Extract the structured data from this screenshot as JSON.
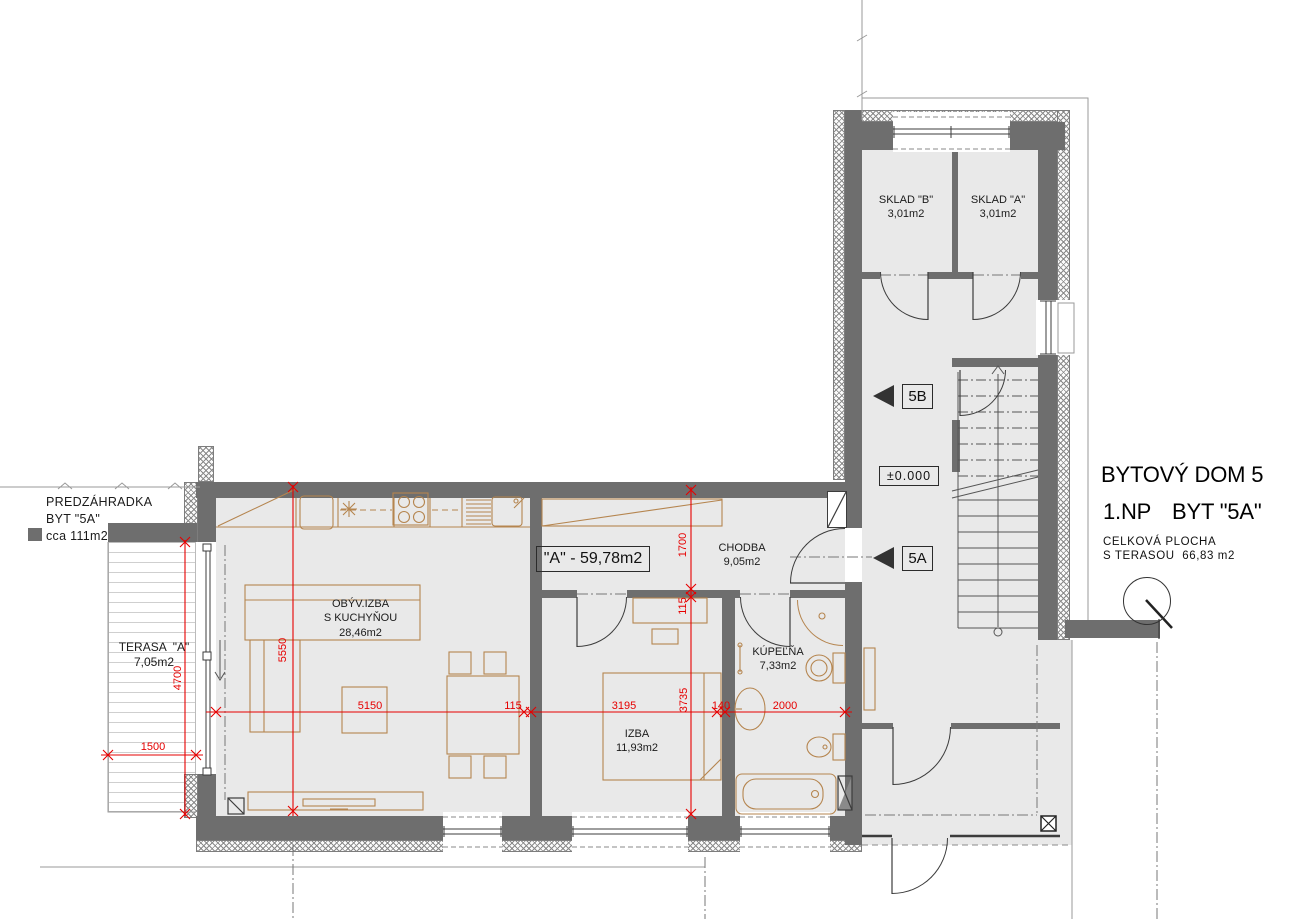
{
  "title_block": {
    "building": "BYTOVÝ DOM 5",
    "floor": "1.NP",
    "unit": "BYT \"5A\"",
    "total_label_line1": "CELKOVÁ PLOCHA",
    "total_label_line2": "S TERASOU  66,83 m2"
  },
  "unit_markers": {
    "upper": "5B",
    "lower": "5A"
  },
  "level_marker": "±0.000",
  "apartment_area_box": "\"A\" - 59,78m2",
  "front_garden": {
    "line1": "PREDZÁHRADKA",
    "line2": "BYT \"5A\"",
    "line3": "cca 111m2"
  },
  "rooms": {
    "sklad_b": {
      "name": "SKLAD \"B\"",
      "area": "3,01m2"
    },
    "sklad_a": {
      "name": "SKLAD \"A\"",
      "area": "3,01m2"
    },
    "chodba": {
      "name": "CHODBA",
      "area": "9,05m2"
    },
    "living": {
      "name": "OBÝV.IZBA",
      "name2": "S KUCHYŇOU",
      "area": "28,46m2"
    },
    "izba": {
      "name": "IZBA",
      "area": "11,93m2"
    },
    "kupelna": {
      "name": "KÚPEĽŇA",
      "area": "7,33m2"
    },
    "terasa": {
      "name": "TERASA  \"A\"",
      "area": "7,05m2"
    }
  },
  "dimensions": {
    "d5550": "5550",
    "d5150": "5150",
    "d115a": "115",
    "d3195": "3195",
    "d140": "140",
    "d2000": "2000",
    "d1700": "1700",
    "d115b": "115",
    "d3735": "3735",
    "d4700": "4700",
    "d1500": "1500"
  },
  "colors": {
    "wall": "#6e6e6e",
    "floor": "#e9e9e9",
    "dimension": "#e60000",
    "furniture": "#b5854f",
    "site_line": "#9a9a9a"
  }
}
